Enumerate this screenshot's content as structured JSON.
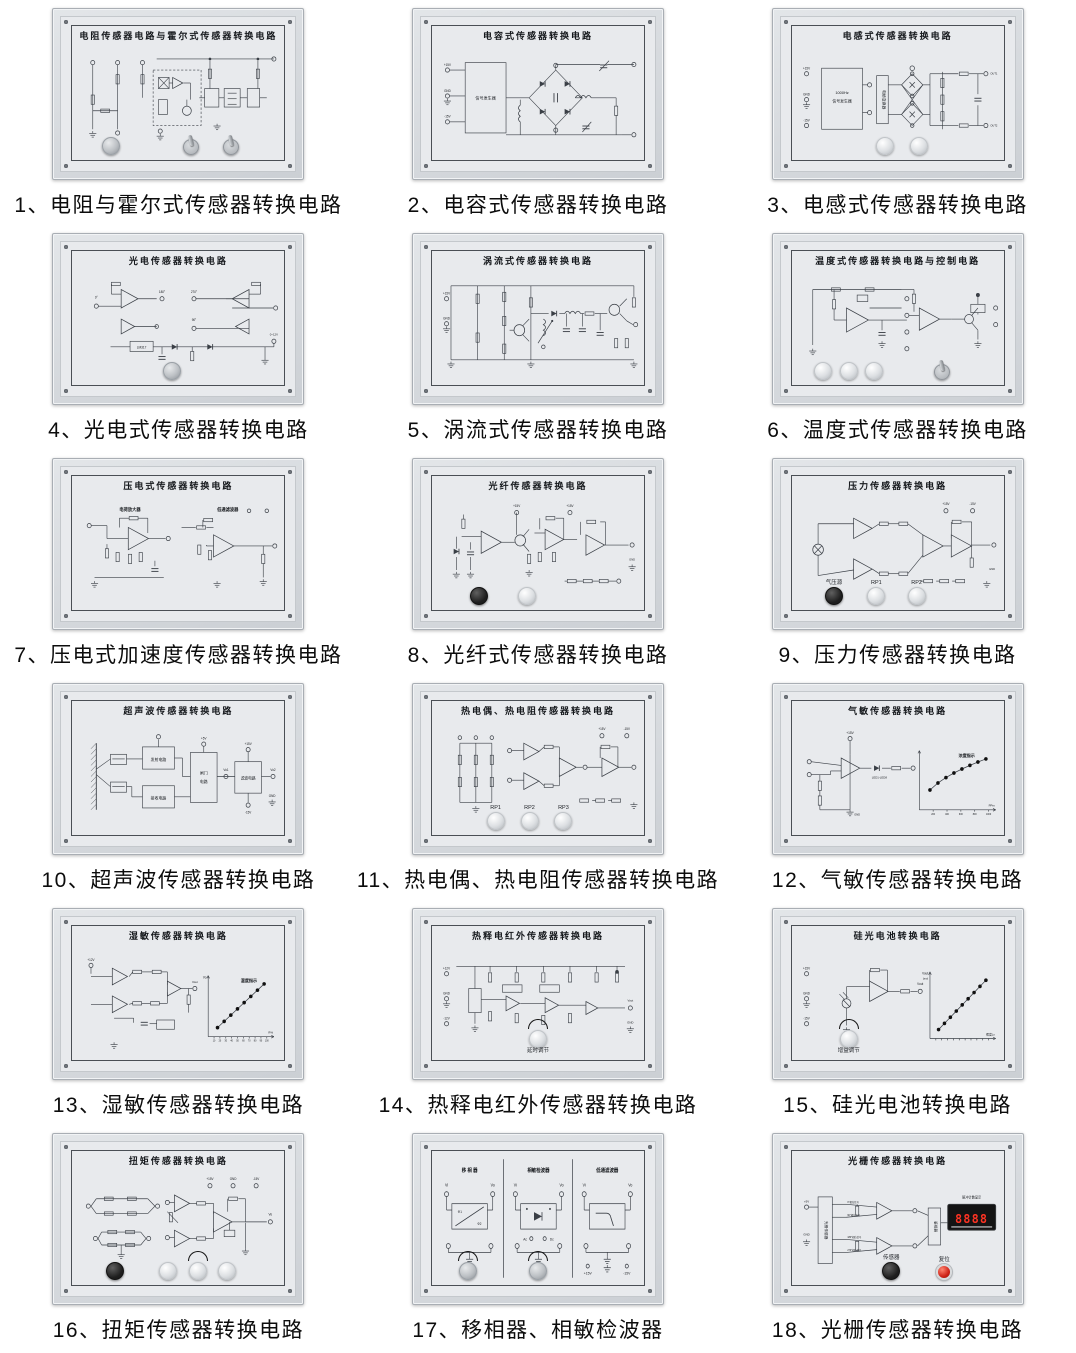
{
  "page": {
    "background": "#ffffff"
  },
  "colors": {
    "frame": "#d7dade",
    "plate": "#e8eaed",
    "line": "#3a3f46",
    "display_bg": "#141414",
    "display_digits": "#ff3323",
    "red_button": "#cf2318"
  },
  "panels": [
    {
      "caption": "1、电阻与霍尔式传感器转换电路",
      "title": "电阻传感器电路与霍尔式传感器转换电路",
      "type": "hall",
      "controls": [
        {
          "kind": "knob-gray",
          "x": 18
        },
        {
          "kind": "toggle",
          "x": 56
        },
        {
          "kind": "toggle",
          "x": 75
        }
      ]
    },
    {
      "caption": "2、电容式传感器转换电路",
      "title": "电容式传感器转换电路",
      "type": "capbridge",
      "box_label": "信号发生器",
      "terminals": [
        "+15V",
        "GND",
        "-15V"
      ]
    },
    {
      "caption": "3、电感式传感器转换电路",
      "title": "电感式传感器转换电路",
      "type": "indbridge",
      "box_line1": "1000Hz",
      "box_line2": "信号发生器",
      "vbox_label": "电桥变换器",
      "out_labels": [
        "OUT1",
        "OUT2"
      ],
      "terminals": [
        "+15V",
        "GND",
        "-15V"
      ],
      "controls": [
        {
          "kind": "knob-white",
          "x": 44
        },
        {
          "kind": "knob-white",
          "x": 60
        }
      ]
    },
    {
      "caption": "4、光电式传感器转换电路",
      "title": "光电传感器转换电路",
      "type": "opamps4",
      "angle_labels": [
        "0°",
        "90°",
        "180°",
        "270°"
      ],
      "chip_label": "LM317",
      "out_label": "0~12V",
      "terminals": [
        "+15V",
        "GND",
        "-15V"
      ],
      "controls": [
        {
          "kind": "knob-gray",
          "x": 47
        }
      ]
    },
    {
      "caption": "5、涡流式传感器转换电路",
      "title": "涡流式传感器转换电路",
      "type": "osc",
      "terminals": [
        "+15V",
        "GND"
      ]
    },
    {
      "caption": "6、温度式传感器转换电路",
      "title": "温度式传感器转换电路与控制电路",
      "type": "temp",
      "controls": [
        {
          "kind": "knob-white",
          "x": 15
        },
        {
          "kind": "knob-white",
          "x": 27
        },
        {
          "kind": "knob-white",
          "x": 39
        },
        {
          "kind": "toggle",
          "x": 71
        }
      ]
    },
    {
      "caption": "7、压电式加速度传感器转换电路",
      "title": "压电式传感器转换电路",
      "type": "charge",
      "sub_left": "电荷放大器",
      "sub_right": "低通滤波器"
    },
    {
      "caption": "8、光纤式传感器转换电路",
      "title": "光纤传感器转换电路",
      "type": "fiber",
      "vcc": "+15V",
      "controls": [
        {
          "kind": "knob-black",
          "x": 22
        },
        {
          "kind": "knob-white",
          "x": 45
        }
      ]
    },
    {
      "caption": "9、压力传感器转换电路",
      "title": "压力传感器转换电路",
      "type": "pressure",
      "top_terminals": [
        "+15V",
        "-15V"
      ],
      "controls": [
        {
          "kind": "knob-black",
          "x": 20,
          "label": "气压源"
        },
        {
          "kind": "knob-white",
          "x": 40,
          "label": "RP1"
        },
        {
          "kind": "knob-white",
          "x": 59,
          "label": "RP2"
        }
      ]
    },
    {
      "caption": "10、超声波传感器转换电路",
      "title": "超声波传感器转换电路",
      "type": "ultra",
      "blocks": [
        "发射电路",
        "接收电路",
        "闸门电路",
        "滤波电路"
      ],
      "labels": {
        "vcc1": "+5V",
        "vcc2": "+15V",
        "vo1": "Vo1",
        "vo2": "Vo2",
        "vneg": "-15V",
        "gnd": "GND"
      }
    },
    {
      "caption": "11、热电偶、热电阻传感器转换电路",
      "title": "热电偶、热电阻传感器转换电路",
      "type": "thermo",
      "top_terminals": [
        "+15V",
        "-15V"
      ],
      "controls": [
        {
          "kind": "knob-white",
          "x": 30,
          "label": "RP1"
        },
        {
          "kind": "knob-white",
          "x": 46,
          "label": "RP2"
        },
        {
          "kind": "knob-white",
          "x": 62,
          "label": "RP3"
        }
      ]
    },
    {
      "caption": "12、气敏传感器转换电路",
      "title": "气敏传感器转换电路",
      "type": "gas",
      "vcc": "+15V",
      "gnd": "GND",
      "led_label": "LED1-LED8",
      "graph": {
        "label": "浓度指示",
        "x_ticks": [
          "200",
          "400",
          "600",
          "800",
          "1000"
        ],
        "x_unit": "PPm",
        "shape": "concave",
        "points": 8
      }
    },
    {
      "caption": "13、湿敏传感器转换电路",
      "title": "湿敏传感器转换电路",
      "type": "humid",
      "vcc": "+12V",
      "out_label": "Vout",
      "graph": {
        "label": "湿度指示",
        "x_ticks": [
          "10",
          "20",
          "30",
          "40",
          "50",
          "60",
          "70",
          "80",
          "90",
          "100"
        ],
        "x_unit": "R%",
        "y_label": "Vo",
        "shape": "linear",
        "points": 8
      }
    },
    {
      "caption": "14、热释电红外传感器转换电路",
      "title": "热释电红外传感器转换电路",
      "type": "ir",
      "out_label": "Vout",
      "gnd": "GND",
      "terminals": [
        "+12V",
        "GND",
        "-12V"
      ],
      "controls": [
        {
          "kind": "knob-white",
          "x": 50,
          "arc": true,
          "label": "延时调节"
        }
      ]
    },
    {
      "caption": "15、硅光电池转换电路",
      "title": "硅光电池转换电路",
      "type": "solar",
      "out_label": "Vout",
      "terminals": [
        "+15V",
        "GND",
        "-15V"
      ],
      "graph": {
        "y_label": "Vout",
        "y_label2": "(mv)",
        "x_unit": "照度Lx",
        "shape": "linear",
        "points": 9
      },
      "controls": [
        {
          "kind": "knob-white",
          "x": 27,
          "arc": true,
          "label": "增益调节"
        }
      ]
    },
    {
      "caption": "16、扭矩传感器转换电路",
      "title": "扭矩传感器转换电路",
      "type": "torque",
      "top_terminals": [
        "+15V",
        "GND",
        "-15V"
      ],
      "out_label": "Vo",
      "controls": [
        {
          "kind": "knob-black",
          "x": 20
        },
        {
          "kind": "knob-white",
          "x": 45
        },
        {
          "kind": "knob-white",
          "x": 59,
          "arc": true
        },
        {
          "kind": "knob-white",
          "x": 73
        }
      ]
    },
    {
      "caption": "17、移相器、相敏检波器",
      "title": "",
      "type": "sections",
      "sections": [
        {
          "name": "移 相 器",
          "box": "phase"
        },
        {
          "name": "相敏检波器",
          "box": "detector"
        },
        {
          "name": "低通滤波器",
          "box": "lowpass"
        }
      ],
      "vi": "Vi",
      "vo": "Vo",
      "ac": "Ac",
      "dc": "Dc",
      "phi1": "Φ1",
      "phi2": "Φ2",
      "psu": [
        "+15V",
        "-15V"
      ],
      "controls": [
        {
          "kind": "knob-gray",
          "x": 17,
          "arc": true
        },
        {
          "kind": "knob-gray",
          "x": 50,
          "arc": true
        }
      ]
    },
    {
      "caption": "18、光栅传感器转换电路",
      "title": "光栅传感器转换电路",
      "type": "grating",
      "vbox_label": "光栅传感器",
      "mid_box": "鉴相器",
      "phase_labels": [
        "0°相位信号",
        "90°相位信号",
        "180°相位信号",
        "270°相位信号"
      ],
      "display_label": "脉冲计数显示",
      "display_value": "8888",
      "left_labels": [
        "+5V",
        "GND"
      ],
      "controls": [
        {
          "kind": "knob-black",
          "x": 47,
          "label": "传感器"
        },
        {
          "kind": "button-red",
          "x": 72,
          "label": "复位"
        }
      ]
    }
  ]
}
